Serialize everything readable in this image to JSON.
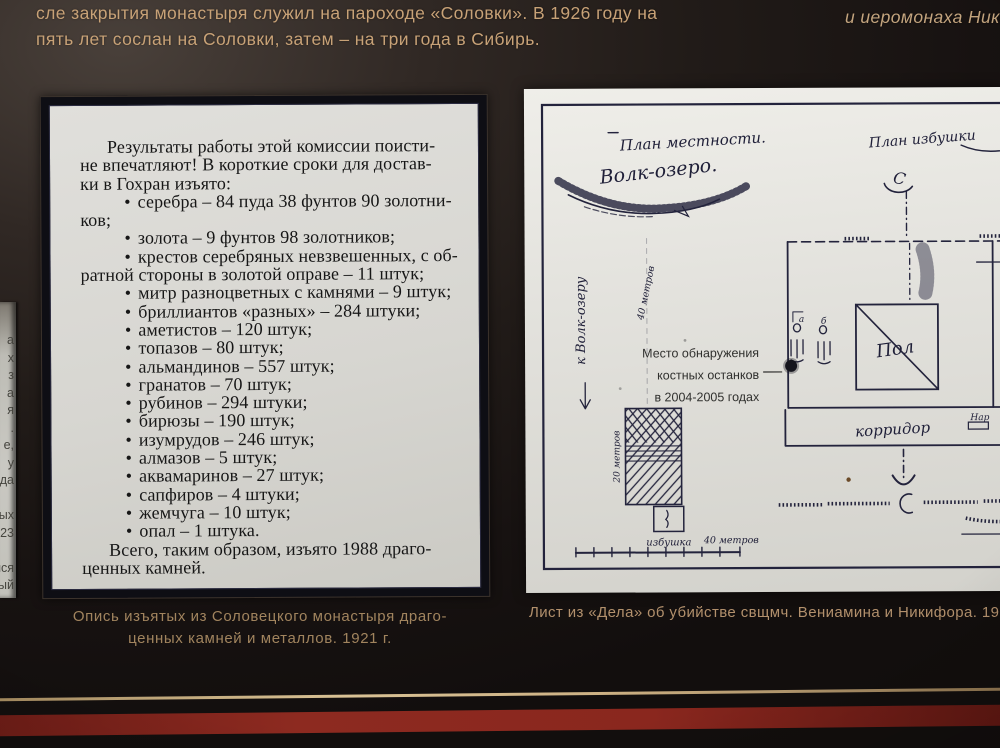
{
  "header": {
    "line1": "сле закрытия монастыря служил на пароходе «Соловки». В 1926 году на",
    "line2": "пять лет сослан на Соловки, затем – на три года в Сибирь.",
    "right_fragment": "и иеромонаха Никифо"
  },
  "left_edge_fragments": [
    "а",
    "х",
    "з",
    "а",
    "я",
    ".",
    "е,",
    "у",
    "да",
    "",
    "ых",
    "023",
    "",
    "лся",
    "ый"
  ],
  "document": {
    "lines": [
      {
        "style": "indent",
        "text": "Результаты работы этой комиссии поисти-"
      },
      {
        "style": "plain",
        "text": "не впечатляют! В короткие сроки для достав-"
      },
      {
        "style": "plain",
        "text": "ки в Гохран изъято:"
      },
      {
        "style": "bullet",
        "text": "серебра – 84 пуда 38 фунтов 90 золотни-"
      },
      {
        "style": "plain",
        "text": "ков;"
      },
      {
        "style": "bullet",
        "text": "золота – 9 фунтов 98 золотников;"
      },
      {
        "style": "bullet",
        "text": "крестов серебряных невзвешенных, с об-"
      },
      {
        "style": "plain",
        "text": "ратной стороны в золотой оправе – 11 штук;"
      },
      {
        "style": "bullet",
        "text": "митр разноцветных с камнями – 9 штук;"
      },
      {
        "style": "bullet",
        "text": "бриллиантов «разных» – 284 штуки;"
      },
      {
        "style": "bullet",
        "text": "аметистов – 120 штук;"
      },
      {
        "style": "bullet",
        "text": "топазов – 80 штук;"
      },
      {
        "style": "bullet",
        "text": "альмандинов – 557 штук;"
      },
      {
        "style": "bullet",
        "text": "гранатов – 70 штук;"
      },
      {
        "style": "bullet",
        "text": "рубинов – 294 штуки;"
      },
      {
        "style": "bullet",
        "text": "бирюзы – 190 штук;"
      },
      {
        "style": "bullet",
        "text": "изумрудов – 246 штук;"
      },
      {
        "style": "bullet",
        "text": "алмазов – 5 штук;"
      },
      {
        "style": "bullet",
        "text": "аквамаринов – 27 штук;"
      },
      {
        "style": "bullet",
        "text": "сапфиров – 4 штуки;"
      },
      {
        "style": "bullet",
        "text": "жемчуга – 10 штук;"
      },
      {
        "style": "bullet",
        "text": "опал – 1 штука."
      },
      {
        "style": "indent",
        "text": "Всего, таким образом, изъято 1988 драго-"
      },
      {
        "style": "plain",
        "text": "ценных камней."
      }
    ]
  },
  "captions": {
    "left_line1": "Опись изъятых из Соловецкого монастыря драго-",
    "left_line2": "ценных камней и металлов. 1921 г.",
    "right": "Лист из «Дела» об убийстве свщмч. Вениамина и Никифора. 192"
  },
  "map": {
    "plan_title": "План местности.",
    "lake_label": "Волк-озеро.",
    "hut_plan_title": "План избушки",
    "north_mark": "С",
    "floor_label": "Пол",
    "corridor_label": "корридор",
    "hut_label": "избушка",
    "scale_label": "40 метров",
    "side_label": "20 метров",
    "distance_label": "40 метров",
    "direction_label": "к Волк-озеру",
    "nar_label": "Нар",
    "mark_a": "а",
    "mark_b": "б",
    "annotation": [
      "Место обнаружения",
      "костных останков",
      "в 2004-2005 годах"
    ]
  },
  "colors": {
    "accent-gold": "#cdb184",
    "accent-red": "#7d2018",
    "header-text": "#c8a277",
    "caption-text": "#a1845e",
    "paper": "#d7d6d1",
    "map-ink": "#23233c"
  }
}
